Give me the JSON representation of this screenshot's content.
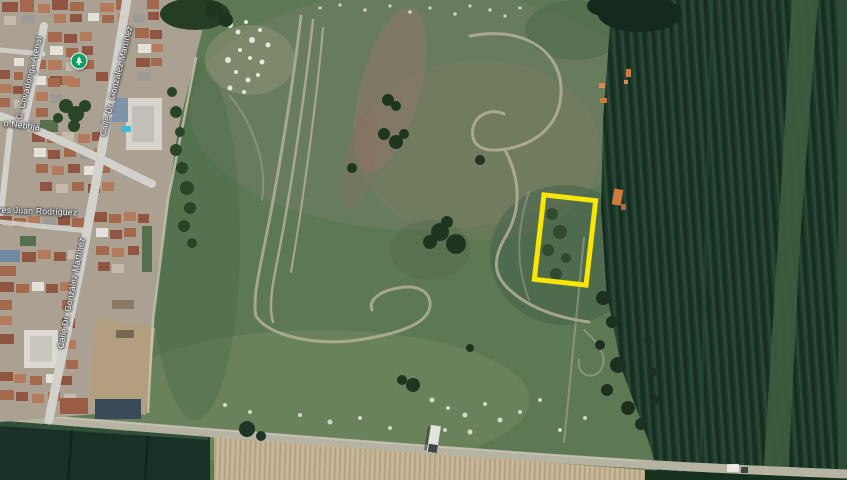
{
  "map": {
    "view_type": "satellite",
    "street_labels": {
      "covadonga": "C. Covadonga Arenal",
      "gonzalez_upper": "Calle Dr. González Martínez",
      "gonzalez_lower": "Calle Dr. González Martínez",
      "nebrija": "o Nebrija",
      "rodriguez": "res Juan Rodríguez"
    },
    "marker": {
      "kind": "park-poi",
      "color": "#0f9d63",
      "x": 79,
      "y": 61
    },
    "highlight": {
      "shape": "rectangle",
      "stroke_color": "#f7e703",
      "stroke_width_px": 5.5,
      "center_x": 565,
      "center_y": 240,
      "width_px": 57,
      "height_px": 90,
      "rotation_deg": 6.5
    },
    "palette": {
      "field_green": "#5d7953",
      "crop_dark_green": "#1e3a2b",
      "plowed_tan": "#c7b697",
      "road_gray": "#b7b3a3",
      "street_gray": "#d2d1cc"
    }
  }
}
